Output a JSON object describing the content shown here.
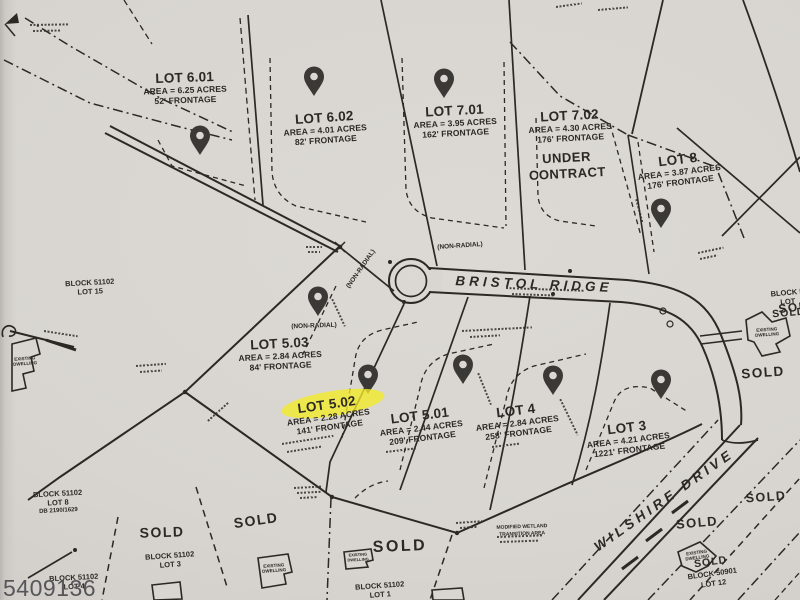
{
  "map": {
    "photo_number": "5409136",
    "roads": [
      {
        "name": "BRISTOL RIDGE"
      },
      {
        "name": "WILSHIRE DRIVE"
      }
    ],
    "sold": "SOLD",
    "lots": [
      {
        "name": "LOT 6.01",
        "area": "AREA = 6.25 ACRES",
        "frontage": "52' FRONTAGE",
        "pin": true
      },
      {
        "name": "LOT 6.02",
        "area": "AREA = 4.01 ACRES",
        "frontage": "82' FRONTAGE",
        "pin": true
      },
      {
        "name": "LOT 7.01",
        "area": "AREA = 3.95 ACRES",
        "frontage": "162' FRONTAGE",
        "pin": true
      },
      {
        "name": "LOT 7.02",
        "area": "AREA = 4.30 ACRES",
        "frontage": "176' FRONTAGE",
        "status": "UNDER CONTRACT",
        "pin": false
      },
      {
        "name": "LOT 8",
        "area": "AREA = 3.87 ACRES",
        "frontage": "176' FRONTAGE",
        "pin": true
      },
      {
        "name": "LOT 5.03",
        "area": "AREA = 2.84 ACRES",
        "frontage": "84' FRONTAGE",
        "pin": true
      },
      {
        "name": "LOT 5.02",
        "area": "AREA = 2.28 ACRES",
        "frontage": "141' FRONTAGE",
        "pin": true,
        "highlighted": true
      },
      {
        "name": "LOT 5.01",
        "area": "AREA = 2.44 ACRES",
        "frontage": "209' FRONTAGE",
        "pin": true
      },
      {
        "name": "LOT 4",
        "area": "AREA = 2.84 ACRES",
        "frontage": "258' FRONTAGE",
        "pin": true
      },
      {
        "name": "LOT 3",
        "area": "AREA = 4.21 ACRES",
        "frontage": "1221' FRONTAGE",
        "pin": true
      }
    ],
    "neighboring_parcels": [
      {
        "block": "BLOCK 51102",
        "lot": "LOT 15"
      },
      {
        "block": "BLOCK 51102",
        "lot": "LOT 8",
        "deed": "DB 2190/1629"
      },
      {
        "block": "BLOCK 51102",
        "lot": "LOT 3"
      },
      {
        "block": "BLOCK 51102",
        "lot": "LOT 4"
      },
      {
        "block": "BLOCK 51102",
        "lot": "LOT 1"
      },
      {
        "block": "BLOCK 50901",
        "lot": "LOT 12"
      },
      {
        "block": "BLOCK 5",
        "lot": "LOT"
      }
    ],
    "annotations": {
      "non_radial": "(NON-RADIAL)",
      "wetland_line1": "MODIFIED WETLAND",
      "wetland_line2": "TRANSITION AREA",
      "existing_dwelling": "EXISTING DWELLING"
    },
    "colors": {
      "paper": "#d9d6d1",
      "ink": "#2b2825",
      "highlight": "#f2ec25",
      "pin": "#3b3936",
      "watermark": "#56565a"
    }
  }
}
